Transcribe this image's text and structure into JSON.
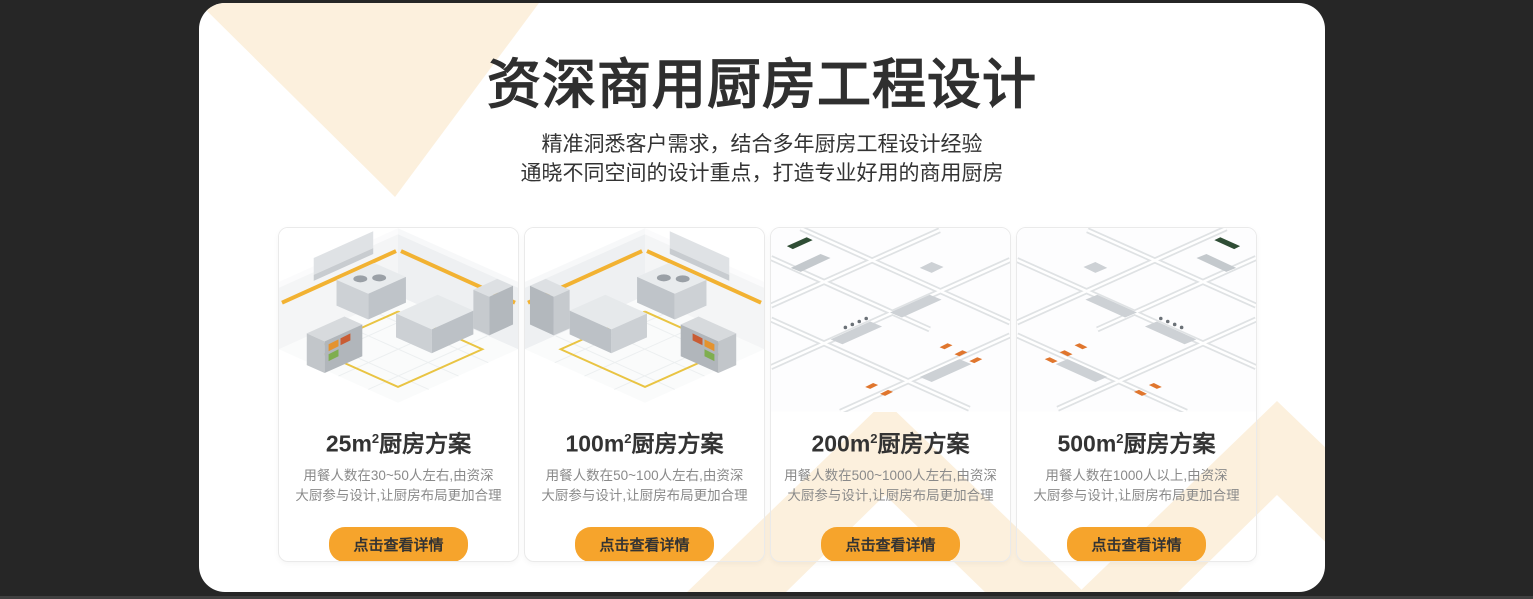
{
  "page": {
    "background_color": "#262626",
    "panel_color": "#ffffff",
    "decor_color": "#fcf0dd",
    "accent_color": "#f6a42c",
    "title_color": "#2f2f2f",
    "description_color": "#8a8a8a"
  },
  "header": {
    "title": "资深商用厨房工程设计",
    "subtitle_lines": [
      "精准洞悉客户需求，结合多年厨房工程设计经验",
      "通晓不同空间的设计重点，打造专业好用的商用厨房"
    ]
  },
  "cards": [
    {
      "title_area": "25m",
      "title_exponent": "2",
      "title_suffix": "厨房方案",
      "description_line1": "用餐人数在30~50人左右,由资深",
      "description_line2": "大厨参与设计,让厨房布局更加合理",
      "button_label": "点击查看详情"
    },
    {
      "title_area": "100m",
      "title_exponent": "2",
      "title_suffix": "厨房方案",
      "description_line1": "用餐人数在50~100人左右,由资深",
      "description_line2": "大厨参与设计,让厨房布局更加合理",
      "button_label": "点击查看详情"
    },
    {
      "title_area": "200m",
      "title_exponent": "2",
      "title_suffix": "厨房方案",
      "description_line1": "用餐人数在500~1000人左右,由资深",
      "description_line2": "大厨参与设计,让厨房布局更加合理",
      "button_label": "点击查看详情"
    },
    {
      "title_area": "500m",
      "title_exponent": "2",
      "title_suffix": "厨房方案",
      "description_line1": "用餐人数在1000人以上,由资深",
      "description_line2": "大厨参与设计,让厨房布局更加合理",
      "button_label": "点击查看详情"
    }
  ]
}
